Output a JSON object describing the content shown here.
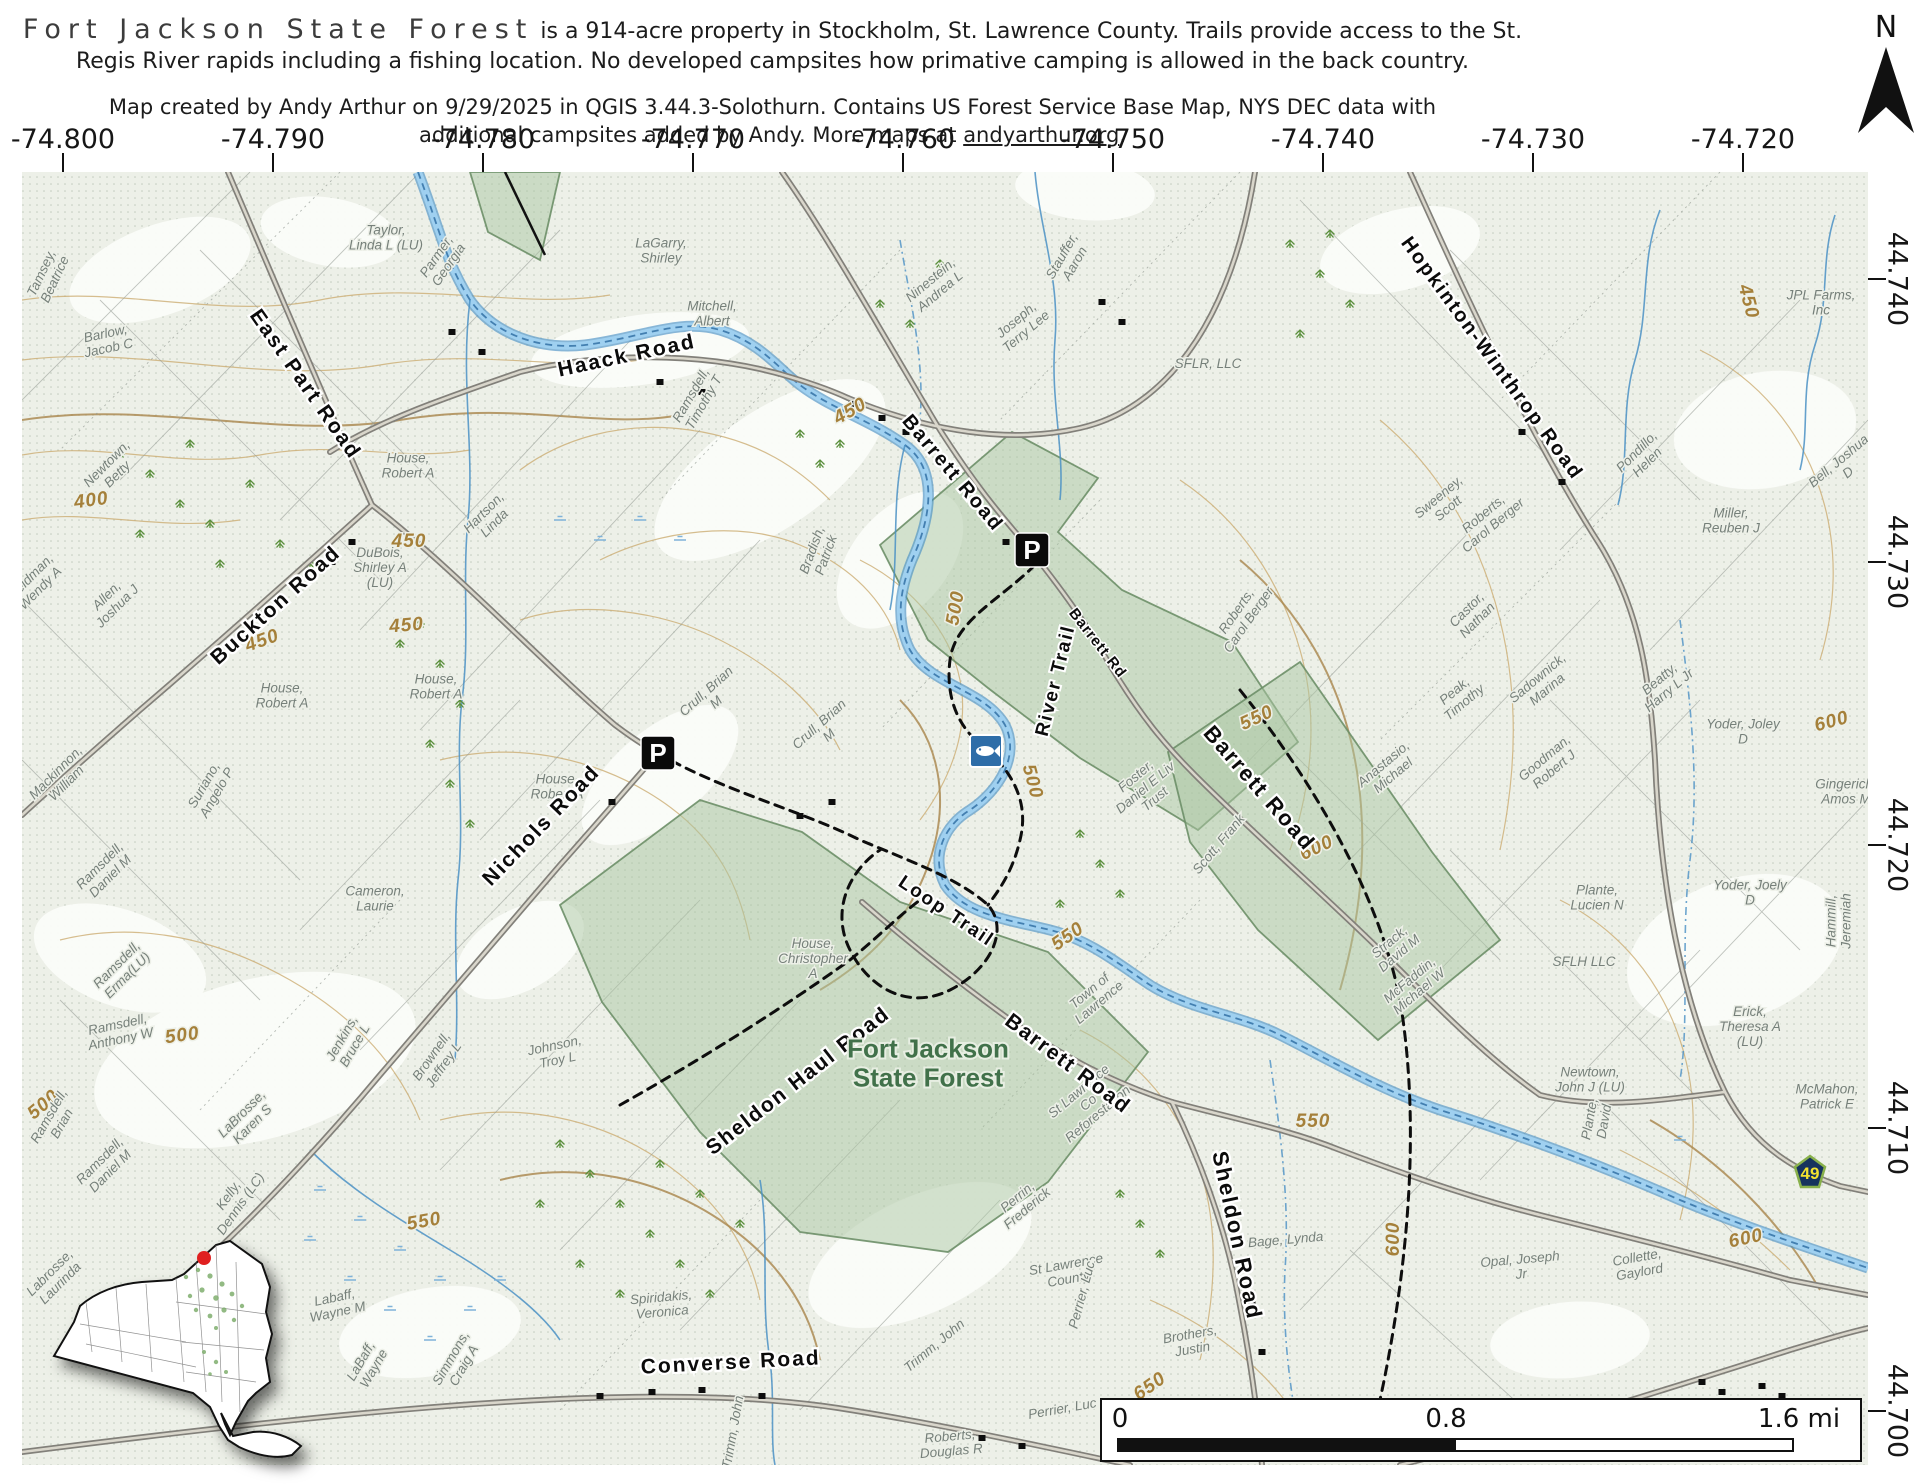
{
  "header": {
    "title": "Fort Jackson State Forest",
    "desc_rest": " is a 914-acre property in Stockholm, St. Lawrence County. Trails provide access to the St.",
    "desc_line2": "Regis River rapids including a fishing location. No developed campsites how primative camping is allowed in the back country.",
    "credit_line1": "Map created by Andy Arthur on 9/29/2025 in QGIS 3.44.3-Solothurn. Contains US Forest Service Base Map, NYS DEC data with",
    "credit_line2_pre": "additional campsites added by Andy. More maps at ",
    "credit_link": "andyarthur.org",
    "credit_suffix": ".",
    "north_label": "N"
  },
  "grid": {
    "lon": [
      {
        "text": "-74.800",
        "x": 63
      },
      {
        "text": "-74.790",
        "x": 273
      },
      {
        "text": "-74.780",
        "x": 483
      },
      {
        "text": "-74.770",
        "x": 693
      },
      {
        "text": "-74.760",
        "x": 903
      },
      {
        "text": "-74.750",
        "x": 1113
      },
      {
        "text": "-74.740",
        "x": 1323
      },
      {
        "text": "-74.730",
        "x": 1533
      },
      {
        "text": "-74.720",
        "x": 1743
      }
    ],
    "lat": [
      {
        "text": "44.740",
        "y": 279
      },
      {
        "text": "44.730",
        "y": 562
      },
      {
        "text": "44.720",
        "y": 845
      },
      {
        "text": "44.710",
        "y": 1128
      },
      {
        "text": "44.700",
        "y": 1411
      }
    ]
  },
  "scalebar": {
    "start": "0",
    "mid": "0.8",
    "end": "1.6 mi"
  },
  "icons": {
    "parking": {
      "label": "P",
      "points": [
        {
          "x": 1032,
          "y": 550
        },
        {
          "x": 658,
          "y": 753
        }
      ]
    },
    "fishing": {
      "x": 986,
      "y": 751
    },
    "route_shield": {
      "text": "49",
      "x": 1810,
      "y": 1172
    }
  },
  "colors": {
    "river": "#9fd0f0",
    "river_edge": "#4a90c4",
    "forest_fill": "#a9c6a2",
    "forest_text": "#41714a",
    "contour": "#c9a86b",
    "shield_bg": "#16335e",
    "shield_text": "#f2e230",
    "red_dot": "#e02020",
    "fishing_bg": "#2e6da8"
  },
  "map_labels": {
    "roads": [
      {
        "text": "East Part Road",
        "x": 300,
        "y": 388,
        "r": 55,
        "s": 21
      },
      {
        "text": "Buckton Road",
        "x": 280,
        "y": 610,
        "r": -42,
        "s": 21
      },
      {
        "text": "Haack Road",
        "x": 628,
        "y": 362,
        "r": -12,
        "s": 21
      },
      {
        "text": "Barrett Road",
        "x": 948,
        "y": 477,
        "r": 50,
        "s": 20
      },
      {
        "text": "Hopkinton-Winthrop Road",
        "x": 1487,
        "y": 362,
        "r": 54,
        "s": 20
      },
      {
        "text": "Nichols Road",
        "x": 546,
        "y": 830,
        "r": -46,
        "s": 21
      },
      {
        "text": "Barrett Road",
        "x": 1254,
        "y": 793,
        "r": 49,
        "s": 22
      },
      {
        "text": "Sheldon Haul Road",
        "x": 802,
        "y": 1086,
        "r": -38,
        "s": 21
      },
      {
        "text": "Barrett Road",
        "x": 1064,
        "y": 1069,
        "r": 37,
        "s": 21
      },
      {
        "text": "Sheldon Road",
        "x": 1230,
        "y": 1237,
        "r": 78,
        "s": 22
      },
      {
        "text": "Converse Road",
        "x": 731,
        "y": 1369,
        "r": -3,
        "s": 21
      }
    ],
    "trails": [
      {
        "text": "Loop Trail",
        "x": 943,
        "y": 916,
        "r": 34
      },
      {
        "text": "River Trail",
        "x": 1061,
        "y": 682,
        "r": -76
      }
    ],
    "small_roads": [
      {
        "text": "Barrett Rd",
        "x": 1094,
        "y": 646,
        "r": 52
      }
    ],
    "forest": [
      {
        "text": "Fort Jackson\nState Forest",
        "x": 928,
        "y": 1072,
        "r": 0
      }
    ],
    "owners": [
      {
        "text": "Tamsey,\nBeatrice",
        "x": 52,
        "y": 278,
        "r": -65
      },
      {
        "text": "Barlow,\nJacob C",
        "x": 108,
        "y": 345,
        "r": -12
      },
      {
        "text": "Taylor,\nLinda L (LU)",
        "x": 386,
        "y": 242,
        "r": 0
      },
      {
        "text": "Parmer,\nGeorgia",
        "x": 446,
        "y": 263,
        "r": -55
      },
      {
        "text": "LaGarry,\nShirley",
        "x": 661,
        "y": 255,
        "r": 0
      },
      {
        "text": "Mitchell,\nAlbert",
        "x": 712,
        "y": 318,
        "r": 0
      },
      {
        "text": "Ramsdell,\nTimothy T",
        "x": 701,
        "y": 401,
        "r": -60
      },
      {
        "text": "Ninestein,\nAndrea L",
        "x": 938,
        "y": 289,
        "r": -40
      },
      {
        "text": "Joseph,\nTerry Lee",
        "x": 1024,
        "y": 329,
        "r": -40
      },
      {
        "text": "Stauffer,\nAaron",
        "x": 1072,
        "y": 262,
        "r": -60
      },
      {
        "text": "SFLR, LLC",
        "x": 1208,
        "y": 368,
        "r": 0
      },
      {
        "text": "Newtown,\nBetty",
        "x": 115,
        "y": 472,
        "r": -45
      },
      {
        "text": "House,\nRobert A",
        "x": 408,
        "y": 470,
        "r": 0
      },
      {
        "text": "DuBois,\nShirley A\n(LU)",
        "x": 380,
        "y": 572,
        "r": 0
      },
      {
        "text": "Hartson,\nLinda",
        "x": 492,
        "y": 521,
        "r": -45
      },
      {
        "text": "Allen,\nJoshua J",
        "x": 115,
        "y": 604,
        "r": -45
      },
      {
        "text": "Weidman,\nWendy A",
        "x": 38,
        "y": 586,
        "r": -45
      },
      {
        "text": "Mackinnon,\nWilliam",
        "x": 64,
        "y": 781,
        "r": -45
      },
      {
        "text": "Suriano,\nAngelo P",
        "x": 214,
        "y": 791,
        "r": -60
      },
      {
        "text": "House,\nRobert A",
        "x": 282,
        "y": 700,
        "r": 0
      },
      {
        "text": "House,\nRobert A",
        "x": 436,
        "y": 691,
        "r": 0
      },
      {
        "text": "House,\nRobert A",
        "x": 557,
        "y": 791,
        "r": 0
      },
      {
        "text": "Crull, Brian\nM",
        "x": 714,
        "y": 700,
        "r": -42
      },
      {
        "text": "Crull, Brian\nM",
        "x": 827,
        "y": 733,
        "r": -42
      },
      {
        "text": "House,\nChristopher\nA",
        "x": 813,
        "y": 963,
        "r": 0
      },
      {
        "text": "Cameron,\nLaurie",
        "x": 375,
        "y": 903,
        "r": 0
      },
      {
        "text": "Brownell,\nJeffrey L",
        "x": 441,
        "y": 1063,
        "r": -55
      },
      {
        "text": "Johnson,\nTroy L",
        "x": 557,
        "y": 1057,
        "r": -12
      },
      {
        "text": "Ramsdell,\nAnthony W",
        "x": 120,
        "y": 1036,
        "r": -12
      },
      {
        "text": "Ramsdell,\nBrian",
        "x": 59,
        "y": 1122,
        "r": -60
      },
      {
        "text": "Ramsdell,\nDaniel M",
        "x": 108,
        "y": 874,
        "r": -45
      },
      {
        "text": "Ramsdell,\nDaniel M",
        "x": 108,
        "y": 1169,
        "r": -45
      },
      {
        "text": "Ramsdell,\nErma(LU)",
        "x": 125,
        "y": 973,
        "r": -45
      },
      {
        "text": "LaBrosse,\nKaren S",
        "x": 250,
        "y": 1122,
        "r": -45
      },
      {
        "text": "Labrosse,\nLaurinda",
        "x": 58,
        "y": 1281,
        "r": -45
      },
      {
        "text": "Kelly,\nDennis (LC)",
        "x": 238,
        "y": 1202,
        "r": -55
      },
      {
        "text": "Jenkins,\nBruce L",
        "x": 352,
        "y": 1044,
        "r": -60
      },
      {
        "text": "Labaff,\nWayne M",
        "x": 337,
        "y": 1309,
        "r": -12
      },
      {
        "text": "LaBaff,\nWayne",
        "x": 371,
        "y": 1367,
        "r": -60
      },
      {
        "text": "Simmons,\nCraig A",
        "x": 461,
        "y": 1364,
        "r": -60
      },
      {
        "text": "Spiridakis,\nVeronica",
        "x": 662,
        "y": 1309,
        "r": -5
      },
      {
        "text": "Town of\nLawrence",
        "x": 1097,
        "y": 1000,
        "r": -40
      },
      {
        "text": "St Lawrence\nCo\nReforestation",
        "x": 1091,
        "y": 1106,
        "r": -40
      },
      {
        "text": "St Lawrence\nCounty",
        "x": 1068,
        "y": 1276,
        "r": -10
      },
      {
        "text": "Perrin,\nFrederick",
        "x": 1025,
        "y": 1206,
        "r": -40
      },
      {
        "text": "Perrier, Luc",
        "x": 1086,
        "y": 1296,
        "r": -75
      },
      {
        "text": "Perrier, Luc",
        "x": 1063,
        "y": 1413,
        "r": -10
      },
      {
        "text": "Trimm, John",
        "x": 937,
        "y": 1349,
        "r": -40
      },
      {
        "text": "Trimm, John",
        "x": 737,
        "y": 1433,
        "r": -80
      },
      {
        "text": "Brothers,\nJustin",
        "x": 1192,
        "y": 1346,
        "r": -10
      },
      {
        "text": "Roberts,\nDouglas R",
        "x": 951,
        "y": 1448,
        "r": -5
      },
      {
        "text": "Roy G.E.",
        "x": 1243,
        "y": 1456,
        "r": -3
      },
      {
        "text": "Bage, Lynda",
        "x": 1286,
        "y": 1244,
        "r": -5
      },
      {
        "text": "Foster,\nDaniel E Liv\nTrust",
        "x": 1148,
        "y": 791,
        "r": -40
      },
      {
        "text": "Scott, Frank",
        "x": 1222,
        "y": 847,
        "r": -50
      },
      {
        "text": "Roberts,\nCarol Berger",
        "x": 1246,
        "y": 618,
        "r": -55
      },
      {
        "text": "Roberts,\nCarol Berger",
        "x": 1491,
        "y": 523,
        "r": -40
      },
      {
        "text": "Sweeney,\nScott",
        "x": 1446,
        "y": 506,
        "r": -40
      },
      {
        "text": "Castor,\nNathan",
        "x": 1475,
        "y": 618,
        "r": -45
      },
      {
        "text": "Pondillo,\nHelen",
        "x": 1645,
        "y": 460,
        "r": -45
      },
      {
        "text": "Miller,\nReuben J",
        "x": 1731,
        "y": 525,
        "r": 0
      },
      {
        "text": "JPL Farms,\nInc",
        "x": 1821,
        "y": 307,
        "r": 0
      },
      {
        "text": "Bell, Joshua\nD",
        "x": 1846,
        "y": 470,
        "r": -40
      },
      {
        "text": "Peak,\nTimothy",
        "x": 1462,
        "y": 700,
        "r": -40
      },
      {
        "text": "Sadownick,\nMarina",
        "x": 1545,
        "y": 687,
        "r": -40
      },
      {
        "text": "Beatty,\nHarry L Jr",
        "x": 1667,
        "y": 688,
        "r": -40
      },
      {
        "text": "Yoder, Joley\nD",
        "x": 1743,
        "y": 736,
        "r": 0
      },
      {
        "text": "Goodman,\nRobert J",
        "x": 1552,
        "y": 767,
        "r": -40
      },
      {
        "text": "Gingerich,\nAmos M",
        "x": 1846,
        "y": 796,
        "r": 0
      },
      {
        "text": "Anastasio,\nMichael",
        "x": 1391,
        "y": 773,
        "r": -40
      },
      {
        "text": "Plante,\nLucien N",
        "x": 1597,
        "y": 902,
        "r": 0
      },
      {
        "text": "SFLH LLC",
        "x": 1584,
        "y": 966,
        "r": 0
      },
      {
        "text": "Yoder, Joely\nD",
        "x": 1750,
        "y": 897,
        "r": 0
      },
      {
        "text": "Erick,\nTheresa A\n(LU)",
        "x": 1750,
        "y": 1031,
        "r": 0
      },
      {
        "text": "Strack,\nDavid M",
        "x": 1397,
        "y": 951,
        "r": -40
      },
      {
        "text": "McFaddin,\nMichael W",
        "x": 1417,
        "y": 989,
        "r": -40
      },
      {
        "text": "Newtown,\nJohn J (LU)",
        "x": 1590,
        "y": 1084,
        "r": 0
      },
      {
        "text": "McMahon,\nPatrick E",
        "x": 1827,
        "y": 1101,
        "r": 0
      },
      {
        "text": "Hammill,\nJeremiah",
        "x": 1843,
        "y": 921,
        "r": -90
      },
      {
        "text": "Opal, Joseph\nJr",
        "x": 1521,
        "y": 1271,
        "r": -5
      },
      {
        "text": "Collette,\nGaylord",
        "x": 1639,
        "y": 1269,
        "r": -10
      },
      {
        "text": "Plante,\nDavid",
        "x": 1601,
        "y": 1121,
        "r": -80
      },
      {
        "text": "Bradish,\nPatrick",
        "x": 823,
        "y": 554,
        "r": -70
      }
    ],
    "contours": [
      {
        "text": "400",
        "x": 92,
        "y": 506,
        "r": -8
      },
      {
        "text": "450",
        "x": 264,
        "y": 646,
        "r": -20
      },
      {
        "text": "450",
        "x": 407,
        "y": 631,
        "r": -5
      },
      {
        "text": "450",
        "x": 409,
        "y": 547,
        "r": 0
      },
      {
        "text": "450",
        "x": 853,
        "y": 416,
        "r": -30
      },
      {
        "text": "450",
        "x": 1743,
        "y": 303,
        "r": 75
      },
      {
        "text": "500",
        "x": 961,
        "y": 609,
        "r": -80
      },
      {
        "text": "500",
        "x": 1027,
        "y": 783,
        "r": 75
      },
      {
        "text": "500",
        "x": 183,
        "y": 1041,
        "r": -8
      },
      {
        "text": "500",
        "x": 47,
        "y": 1109,
        "r": -40
      },
      {
        "text": "550",
        "x": 1071,
        "y": 941,
        "r": -35
      },
      {
        "text": "550",
        "x": 1259,
        "y": 723,
        "r": -25
      },
      {
        "text": "550",
        "x": 1313,
        "y": 1127,
        "r": 0
      },
      {
        "text": "550",
        "x": 425,
        "y": 1227,
        "r": -10
      },
      {
        "text": "600",
        "x": 1319,
        "y": 853,
        "r": -25
      },
      {
        "text": "600",
        "x": 1747,
        "y": 1244,
        "r": -12
      },
      {
        "text": "600",
        "x": 1399,
        "y": 1239,
        "r": -90
      },
      {
        "text": "600",
        "x": 1833,
        "y": 727,
        "r": -15
      },
      {
        "text": "650",
        "x": 1153,
        "y": 1391,
        "r": -35
      }
    ]
  }
}
